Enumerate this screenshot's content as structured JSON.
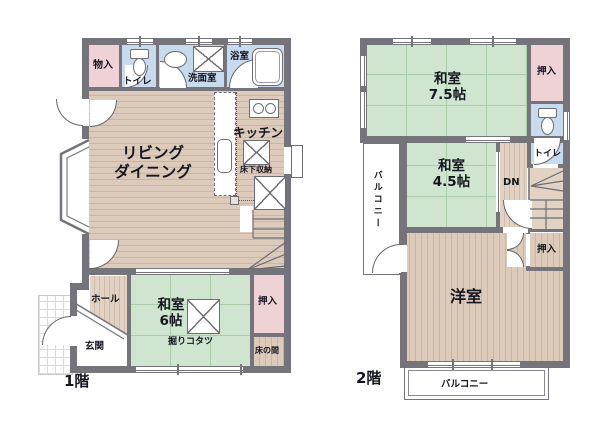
{
  "colors": {
    "wall": "#74747a",
    "tatami": "#cfe5cf",
    "wood": "#dccaba",
    "closet_pink": "#eed2d6",
    "wet_blue": "#c7daee",
    "text": "#15151f"
  },
  "floor1": {
    "label": "1階",
    "rooms": {
      "storage": "物入",
      "toilet": "トイレ",
      "washroom": "洗面室",
      "bathroom": "浴室",
      "living_line1": "リビング",
      "living_line2": "ダイニング",
      "kitchen": "キッチン",
      "underfloor_storage": "床下収納",
      "hall": "ホール",
      "entrance": "玄関",
      "washitsu_name": "和室",
      "washitsu_size": "6帖",
      "kotatsu": "掘りコタツ",
      "closet": "押入",
      "tokonoma": "床の間"
    }
  },
  "floor2": {
    "label": "2階",
    "rooms": {
      "washitsu75_name": "和室",
      "washitsu75_size": "7.5帖",
      "closet_top": "押入",
      "toilet": "トイレ",
      "washitsu45_name": "和室",
      "washitsu45_size": "4.5帖",
      "balcony_left": "バルコニー",
      "down": "DN",
      "closet_mid": "押入",
      "western_room": "洋室",
      "balcony_bottom": "バルコニー"
    }
  }
}
